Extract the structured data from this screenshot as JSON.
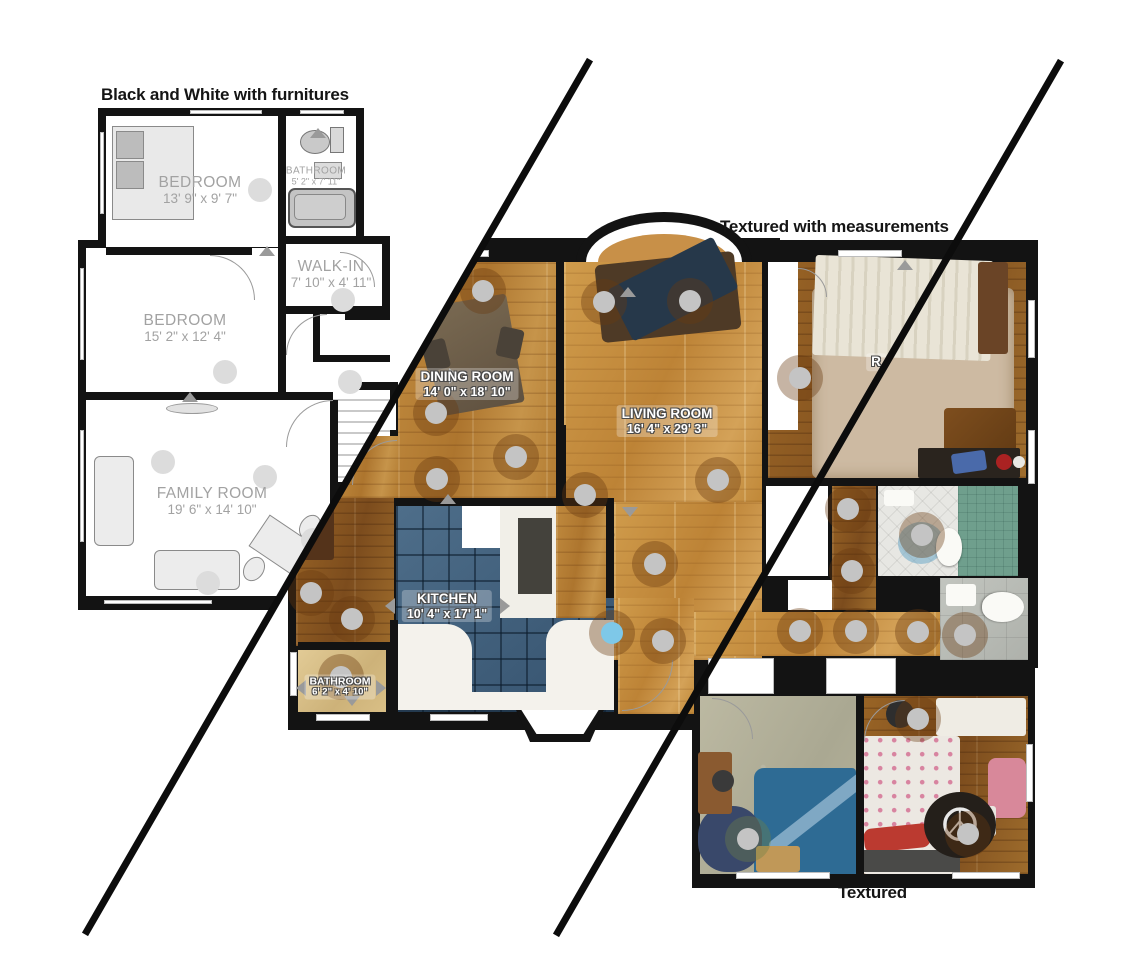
{
  "titles": {
    "bw": "Black and White with furnitures",
    "textured_measurements": "Textured with measurements",
    "textured": "Textured"
  },
  "rooms": {
    "bedroom1": {
      "name": "BEDROOM",
      "dims": "13' 9\" x 9' 7\""
    },
    "bathroom1": {
      "name": "BATHROOM",
      "dims": "5' 2\" x 7' 11\""
    },
    "walkin": {
      "name": "WALK-IN",
      "dims": "7' 10\" x 4' 11\""
    },
    "bedroom2": {
      "name": "BEDROOM",
      "dims": "15' 2\" x 12' 4\""
    },
    "familyroom": {
      "name": "FAMILY ROOM",
      "dims": "19' 6\" x 14' 10\""
    },
    "diningroom": {
      "name": "DINING ROOM",
      "dims": "14' 0\" x 18' 10\""
    },
    "livingroom": {
      "name": "LIVING ROOM",
      "dims": "16' 4\" x 29' 3\""
    },
    "kitchen": {
      "name": "KITCHEN",
      "dims": "10' 4\" x 17' 1\""
    },
    "bathroom2": {
      "name": "BATHROOM",
      "dims": "6' 2\" x 4' 10\""
    },
    "bedroom_partial": {
      "name": "R",
      "dims": ""
    }
  },
  "icons": {
    "peace": "☮"
  },
  "palette": {
    "wall": "#131313",
    "wood_medium": "#b37c32",
    "wood_honey": "#c89048",
    "wood_dark": "#8a5a28",
    "kitchen_tile_blue": "#44607c",
    "bathroom_teal": "#6f9f8d",
    "bathroom_tan": "#d8bf8a",
    "carpet_green": "#b5b29a",
    "scan_point_gray": "#c4c4c4",
    "scan_point_blue": "#7ec8e8",
    "bw_label_gray": "#a2a2a2"
  }
}
